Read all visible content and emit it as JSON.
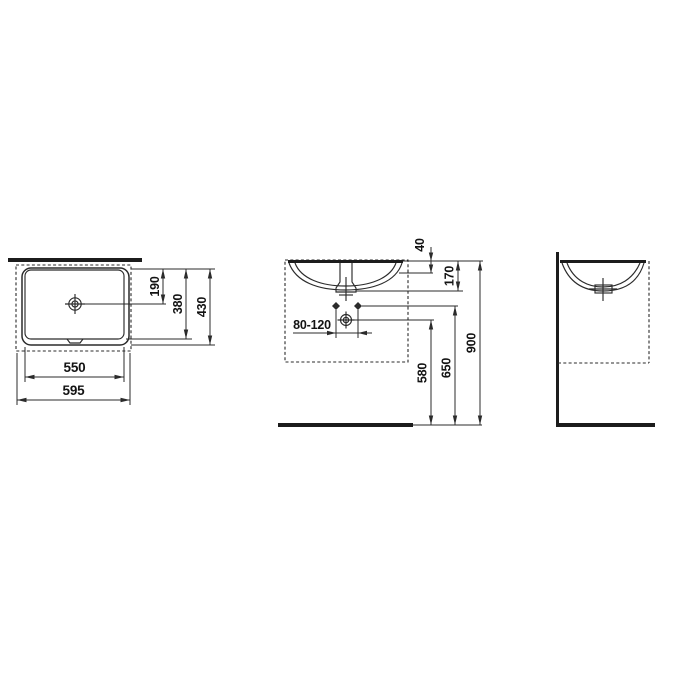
{
  "meta": {
    "kind": "technical dimension drawing",
    "subject": "built-under washbasin",
    "units": "mm",
    "views": [
      "top view",
      "front view",
      "side view"
    ]
  },
  "colors": {
    "line": "#2b2b2b",
    "text": "#131313",
    "background": "#ffffff"
  },
  "dims": {
    "top": {
      "drain_offset": "190",
      "basin_depth": "380",
      "overall_depth": "430",
      "basin_width": "550",
      "overall_width": "595"
    },
    "front": {
      "rim_height": "40",
      "bowl_depth": "170",
      "fixing_span": "80-120",
      "outlet_height": "580",
      "fixing_height": "650",
      "rim_level": "900"
    }
  }
}
